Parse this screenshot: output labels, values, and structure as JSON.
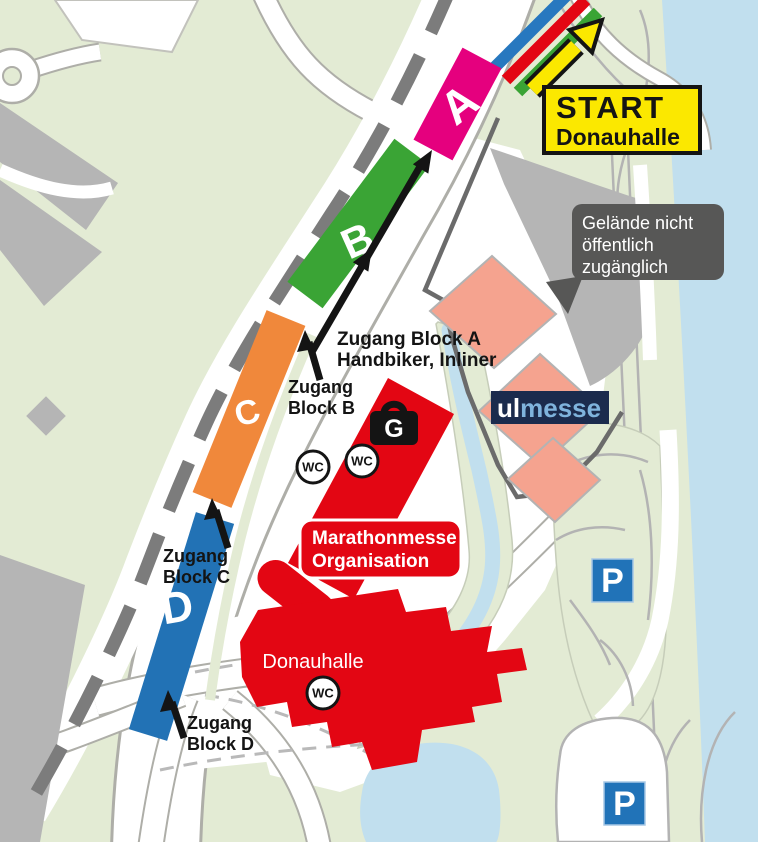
{
  "colors": {
    "background_green": "#e3ebd4",
    "river_blue": "#c1dfee",
    "road_casing": "#aeaea8",
    "area_gray": "#b5b5b5",
    "railway_gray": "#7c7c7c",
    "fence_gray": "#6b6b6b",
    "block_a_pink": "#e5007e",
    "block_b_green": "#3aa435",
    "block_c_orange": "#f0883b",
    "block_d_blue": "#2272b5",
    "course_blue": "#2778bf",
    "course_red": "#e30613",
    "course_green": "#3aa435",
    "building_red": "#e30613",
    "hall_salmon": "#f5a38f",
    "start_yellow": "#fbe800",
    "notice_gray": "#575756",
    "parking_blue": "#2173b8",
    "logo_navy": "#1b2b4d",
    "logo_lightblue": "#7fb3dc",
    "arrow_black": "#141414"
  },
  "start_sign": {
    "line1": "START",
    "line2": "Donauhalle"
  },
  "notice_box": {
    "line1": "Gelände nicht",
    "line2": "öffentlich",
    "line3": "zugänglich"
  },
  "blocks": {
    "a": "A",
    "b": "B",
    "c": "C",
    "d": "D"
  },
  "access_labels": {
    "a": {
      "line1": "Zugang Block A",
      "line2": "Handbiker, Inliner"
    },
    "b": {
      "line1": "Zugang",
      "line2": "Block B"
    },
    "c": {
      "line1": "Zugang",
      "line2": "Block C"
    },
    "d": {
      "line1": "Zugang",
      "line2": "Block D"
    }
  },
  "organisation_box": {
    "line1": "Marathonmesse",
    "line2": "Organisation"
  },
  "donauhalle_label": "Donauhalle",
  "logo": {
    "part1": "ul",
    "part2": "messe"
  },
  "icons": {
    "wc": "WC",
    "luggage": "G",
    "parking": "P"
  }
}
